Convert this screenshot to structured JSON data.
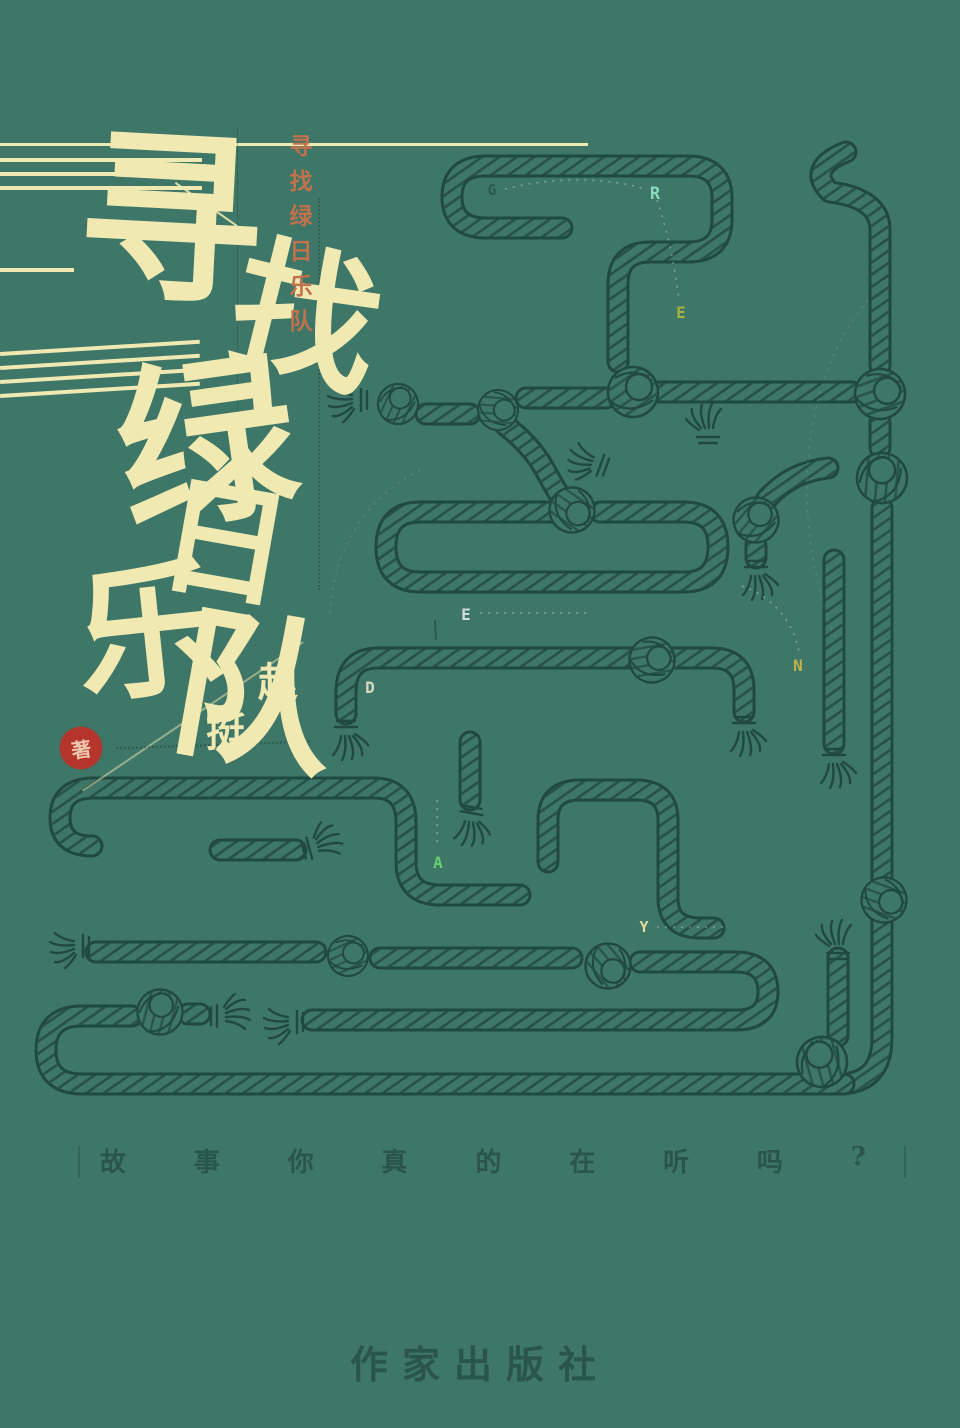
{
  "cover": {
    "background_color": "#3e7668",
    "title": {
      "text": "寻找绿日乐队",
      "chars": [
        "寻",
        "找",
        "绿",
        "日",
        "乐",
        "队"
      ],
      "color": "#f0eab2"
    },
    "side_title": {
      "text": "寻找绿日乐队",
      "color": "#c1714c"
    },
    "author": {
      "chars": [
        "赵",
        "挺"
      ],
      "seal_char": "著",
      "seal_color": "#b5352c",
      "name_color": "#f0eab2"
    },
    "maze": {
      "rope_color": "#204a41",
      "letters": [
        {
          "char": "G",
          "color": "#2b5a4d"
        },
        {
          "char": "R",
          "color": "#8bd8ba"
        },
        {
          "char": "E",
          "color": "#a9b03c"
        },
        {
          "char": "E",
          "color": "#cfdfdb"
        },
        {
          "char": "D",
          "color": "#d8d8c6"
        },
        {
          "char": "N",
          "color": "#c2b14a"
        },
        {
          "char": "A",
          "color": "#67ce74"
        },
        {
          "char": "Y",
          "color": "#e5dc9e"
        }
      ]
    },
    "tagline": {
      "chars": [
        "故",
        "事",
        "你",
        "真",
        "的",
        "在",
        "听",
        "吗",
        "?"
      ],
      "color": "#2a564a"
    },
    "publisher": {
      "name": "作家出版社",
      "color": "#2a564a"
    }
  }
}
